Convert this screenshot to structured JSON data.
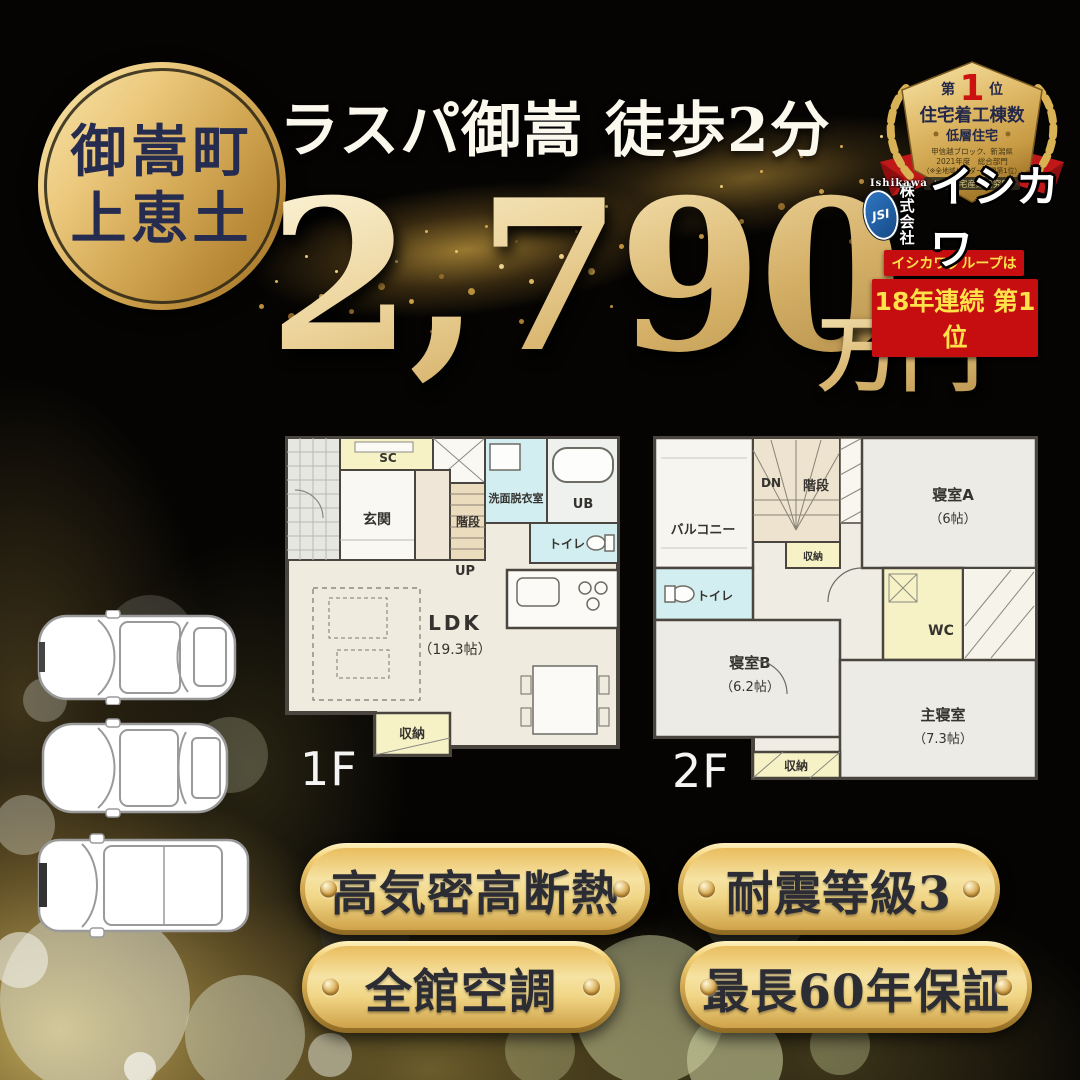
{
  "colors": {
    "gold_accent": "#d7b05e",
    "deep_gold": "#a87f33",
    "brand_red": "#c60d10",
    "banner_yellow": "#ffe14a",
    "navy_text": "#252c50",
    "plan_wet_room": "#d3eef0",
    "plan_storage_yellow": "#f6f2c6"
  },
  "location_badge": {
    "line1": "御嵩町",
    "line2": "上恵土"
  },
  "header": {
    "title": "ラスパ御嵩 徒歩2分",
    "price": "2,790",
    "price_unit": "万円"
  },
  "award": {
    "rank_prefix": "第",
    "rank_number": "1",
    "rank_suffix": "位",
    "category": "住宅着工棟数",
    "subcategory": "低層住宅",
    "region_line": "甲信越ブロック、新潟県",
    "year_line": "2021年度　総合部門",
    "note_line": "（※全地域ビルダー部門第1位）",
    "source_line": "ISK 住宅産業研究所"
  },
  "company": {
    "latin_name": "Ishikawa",
    "monogram": "JSI",
    "prefix_top": "株式",
    "prefix_bottom": "会社",
    "name": "イシカワ",
    "banner_line1": "イシカワグループは",
    "banner_line2": "18年連続 第1位"
  },
  "floorplan_1f": {
    "label": "1F",
    "rooms": {
      "sc": "SC",
      "genkan": "玄関",
      "kaidan": "階段",
      "up": "UP",
      "senmen": "洗面脱衣室",
      "ub": "UB",
      "toilet": "トイレ",
      "ldk": "LDK",
      "ldk_size": "（19.3帖）",
      "shuno": "収納"
    }
  },
  "floorplan_2f": {
    "label": "2F",
    "rooms": {
      "balcony": "バルコニー",
      "dn": "DN",
      "kaidan": "階段",
      "shuno_top": "収納",
      "bedroom_a": "寝室A",
      "bedroom_a_size": "（6帖）",
      "toilet": "トイレ",
      "wc": "WC",
      "bedroom_b": "寝室B",
      "bedroom_b_size": "（6.2帖）",
      "master": "主寝室",
      "master_size": "（7.3帖）",
      "shuno_bottom": "収納"
    }
  },
  "features": [
    "高気密高断熱",
    "耐震等級3",
    "全館空調",
    "最長60年保証"
  ]
}
